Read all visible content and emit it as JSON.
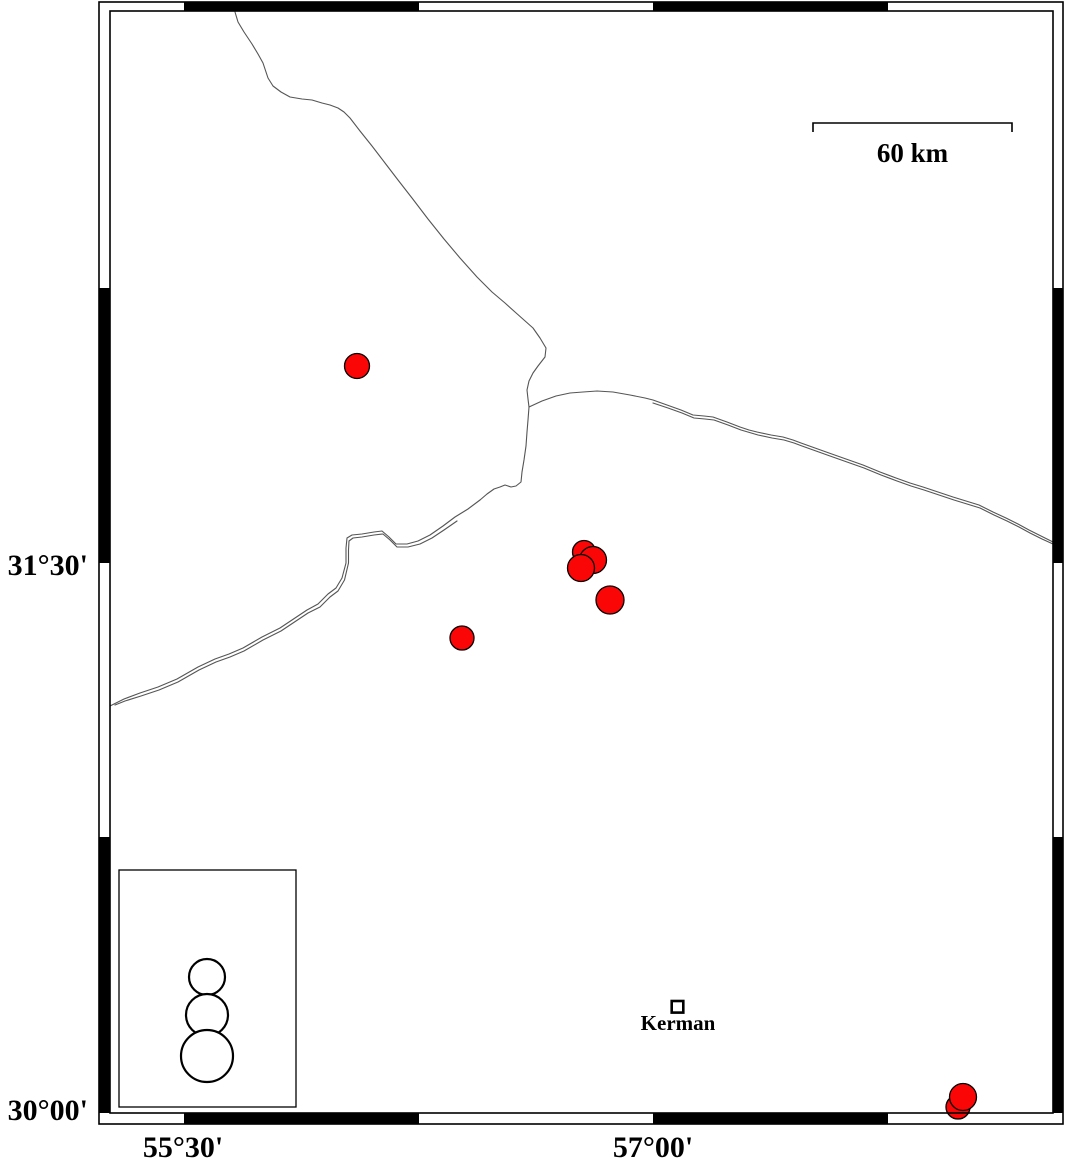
{
  "map": {
    "labels": {
      "lat_upper": "31°30'",
      "lat_lower": "30°00'",
      "lon_left": "55°30'",
      "lon_right": "57°00'",
      "scale": "60 km",
      "city": "Kerman"
    },
    "colors": {
      "epicenter_fill": "#fa0606",
      "epicenter_stroke": "#000000",
      "fault_line": "#555555",
      "frame": "#000000",
      "background": "#ffffff"
    },
    "scale_bar": {
      "x1": 813,
      "x2": 1012,
      "y": 123,
      "tick_drop": 9,
      "length_km": 60
    },
    "city_marker": {
      "x": 671.7,
      "y": 1001,
      "size": 11.6
    },
    "frame": {
      "outer": {
        "x": 99,
        "y": 2,
        "w": 964,
        "h": 1122
      },
      "inner": {
        "x": 110,
        "y": 11,
        "w": 943,
        "h": 1102
      },
      "top_black": [
        [
          184,
          419
        ],
        [
          653,
          888
        ]
      ],
      "bottom_black": [
        [
          184,
          419
        ],
        [
          653,
          888
        ]
      ],
      "left_black": [
        [
          288,
          563
        ],
        [
          837,
          1113
        ]
      ],
      "right_black": [
        [
          288,
          563
        ],
        [
          837,
          1113
        ]
      ]
    },
    "legend": {
      "box": {
        "x": 119,
        "y": 870,
        "w": 177,
        "h": 237
      },
      "circles": [
        {
          "cx": 207,
          "cy": 977,
          "r": 18
        },
        {
          "cx": 207,
          "cy": 1015,
          "r": 21
        },
        {
          "cx": 207,
          "cy": 1056,
          "r": 26
        }
      ]
    },
    "epicenters": [
      {
        "x": 357,
        "y": 366,
        "r": 12.5
      },
      {
        "x": 584,
        "y": 552,
        "r": 11.5
      },
      {
        "x": 593,
        "y": 560,
        "r": 13.5
      },
      {
        "x": 581,
        "y": 568,
        "r": 13.5
      },
      {
        "x": 610,
        "y": 600,
        "r": 14
      },
      {
        "x": 462,
        "y": 638,
        "r": 12
      },
      {
        "x": 958,
        "y": 1107,
        "r": 12
      },
      {
        "x": 963,
        "y": 1097,
        "r": 13.5
      }
    ],
    "faults": [
      {
        "name": "fault-north-south",
        "points": [
          [
            235,
            12
          ],
          [
            238,
            22
          ],
          [
            244,
            32
          ],
          [
            252,
            44
          ],
          [
            258,
            54
          ],
          [
            263,
            63
          ],
          [
            268,
            78
          ],
          [
            273,
            86
          ],
          [
            281,
            92
          ],
          [
            290,
            97
          ],
          [
            302,
            99
          ],
          [
            312,
            100
          ],
          [
            322,
            103
          ],
          [
            330,
            105
          ],
          [
            338,
            108
          ],
          [
            344,
            112
          ],
          [
            350,
            118
          ],
          [
            360,
            131
          ],
          [
            372,
            146
          ],
          [
            385,
            163
          ],
          [
            398,
            180
          ],
          [
            412,
            198
          ],
          [
            428,
            219
          ],
          [
            444,
            239
          ],
          [
            460,
            258
          ],
          [
            477,
            277
          ],
          [
            492,
            292
          ],
          [
            505,
            303
          ],
          [
            515,
            312
          ],
          [
            524,
            320
          ],
          [
            533,
            328
          ],
          [
            540,
            338
          ],
          [
            546,
            348
          ],
          [
            545,
            357
          ],
          [
            538,
            366
          ],
          [
            533,
            373
          ],
          [
            529,
            381
          ],
          [
            527,
            390
          ],
          [
            528,
            399
          ],
          [
            529,
            407
          ],
          [
            528,
            420
          ],
          [
            527,
            432
          ],
          [
            526,
            446
          ],
          [
            524,
            460
          ],
          [
            522,
            472
          ],
          [
            521,
            482
          ],
          [
            516,
            486
          ],
          [
            511,
            487
          ],
          [
            505,
            485
          ],
          [
            500,
            487
          ],
          [
            494,
            489
          ],
          [
            487,
            494
          ],
          [
            480,
            500
          ]
        ]
      },
      {
        "name": "fault-southwest-strand-1",
        "points": [
          [
            480,
            500
          ],
          [
            468,
            509
          ],
          [
            455,
            517
          ],
          [
            443,
            526
          ],
          [
            430,
            535
          ],
          [
            418,
            541
          ],
          [
            407,
            544
          ],
          [
            396,
            544
          ],
          [
            389,
            537
          ],
          [
            382,
            531
          ],
          [
            374,
            532
          ],
          [
            362,
            534
          ],
          [
            352,
            535
          ],
          [
            347,
            538
          ],
          [
            346,
            548
          ],
          [
            346,
            563
          ],
          [
            342,
            578
          ],
          [
            336,
            588
          ],
          [
            328,
            594
          ],
          [
            318,
            604
          ],
          [
            307,
            610
          ],
          [
            295,
            618
          ],
          [
            280,
            628
          ],
          [
            262,
            637
          ],
          [
            243,
            648
          ],
          [
            229,
            654
          ],
          [
            215,
            659
          ],
          [
            198,
            667
          ],
          [
            177,
            679
          ],
          [
            158,
            687
          ],
          [
            140,
            693
          ],
          [
            124,
            699
          ],
          [
            110,
            706
          ]
        ]
      },
      {
        "name": "fault-southwest-strand-2",
        "points": [
          [
            457,
            521
          ],
          [
            444,
            530
          ],
          [
            432,
            538
          ],
          [
            420,
            544
          ],
          [
            408,
            547
          ],
          [
            397,
            547
          ],
          [
            390,
            540
          ],
          [
            383,
            534
          ],
          [
            374,
            535
          ],
          [
            362,
            537
          ],
          [
            353,
            538
          ],
          [
            349,
            541
          ],
          [
            348.5,
            550
          ],
          [
            348.5,
            563
          ],
          [
            344.5,
            580
          ],
          [
            338,
            591
          ],
          [
            330,
            597
          ],
          [
            320,
            607
          ],
          [
            308,
            613
          ],
          [
            296,
            621
          ],
          [
            281,
            631
          ],
          [
            263,
            640
          ],
          [
            244,
            651
          ],
          [
            230,
            657
          ],
          [
            216,
            662
          ],
          [
            199,
            670
          ],
          [
            178,
            682
          ],
          [
            159,
            690
          ],
          [
            141,
            696
          ],
          [
            125,
            701
          ],
          [
            115,
            705
          ]
        ]
      },
      {
        "name": "fault-east-strand-1",
        "points": [
          [
            529,
            407
          ],
          [
            542,
            401
          ],
          [
            556,
            396
          ],
          [
            570,
            393
          ],
          [
            583,
            392
          ],
          [
            597,
            391
          ],
          [
            613,
            392
          ],
          [
            630,
            395
          ],
          [
            645,
            398
          ],
          [
            653,
            400
          ],
          [
            667,
            405
          ],
          [
            681,
            410
          ],
          [
            693,
            415
          ],
          [
            704,
            416
          ],
          [
            713,
            417
          ],
          [
            727,
            422
          ],
          [
            740,
            427
          ],
          [
            749,
            430
          ],
          [
            757,
            432
          ],
          [
            771,
            435
          ],
          [
            783,
            437
          ],
          [
            793,
            440
          ],
          [
            801,
            443
          ],
          [
            815,
            448
          ],
          [
            829,
            453
          ],
          [
            846,
            459
          ],
          [
            863,
            465
          ],
          [
            880,
            472
          ],
          [
            896,
            478
          ],
          [
            910,
            483
          ],
          [
            923,
            487
          ],
          [
            938,
            492
          ],
          [
            953,
            497
          ],
          [
            966,
            501
          ],
          [
            979,
            505
          ],
          [
            993,
            512
          ],
          [
            1006,
            518
          ],
          [
            1018,
            524
          ],
          [
            1029,
            530
          ],
          [
            1041,
            536
          ],
          [
            1053,
            542
          ]
        ]
      },
      {
        "name": "fault-east-strand-2",
        "points": [
          [
            653,
            403
          ],
          [
            668,
            408
          ],
          [
            682,
            413
          ],
          [
            694,
            418
          ],
          [
            705,
            419
          ],
          [
            714,
            420
          ],
          [
            728,
            425
          ],
          [
            741,
            430
          ],
          [
            758,
            435
          ],
          [
            772,
            438
          ],
          [
            784,
            440
          ],
          [
            794,
            443
          ],
          [
            802,
            446
          ],
          [
            816,
            451
          ],
          [
            830,
            456
          ],
          [
            847,
            462
          ],
          [
            864,
            468
          ],
          [
            881,
            475
          ],
          [
            897,
            481
          ],
          [
            911,
            486
          ],
          [
            924,
            490
          ],
          [
            939,
            495
          ],
          [
            954,
            500
          ],
          [
            967,
            504
          ],
          [
            980,
            508
          ],
          [
            994,
            515
          ],
          [
            1007,
            521
          ],
          [
            1019,
            527
          ],
          [
            1030,
            533
          ],
          [
            1042,
            539
          ],
          [
            1053,
            544
          ]
        ]
      }
    ]
  }
}
